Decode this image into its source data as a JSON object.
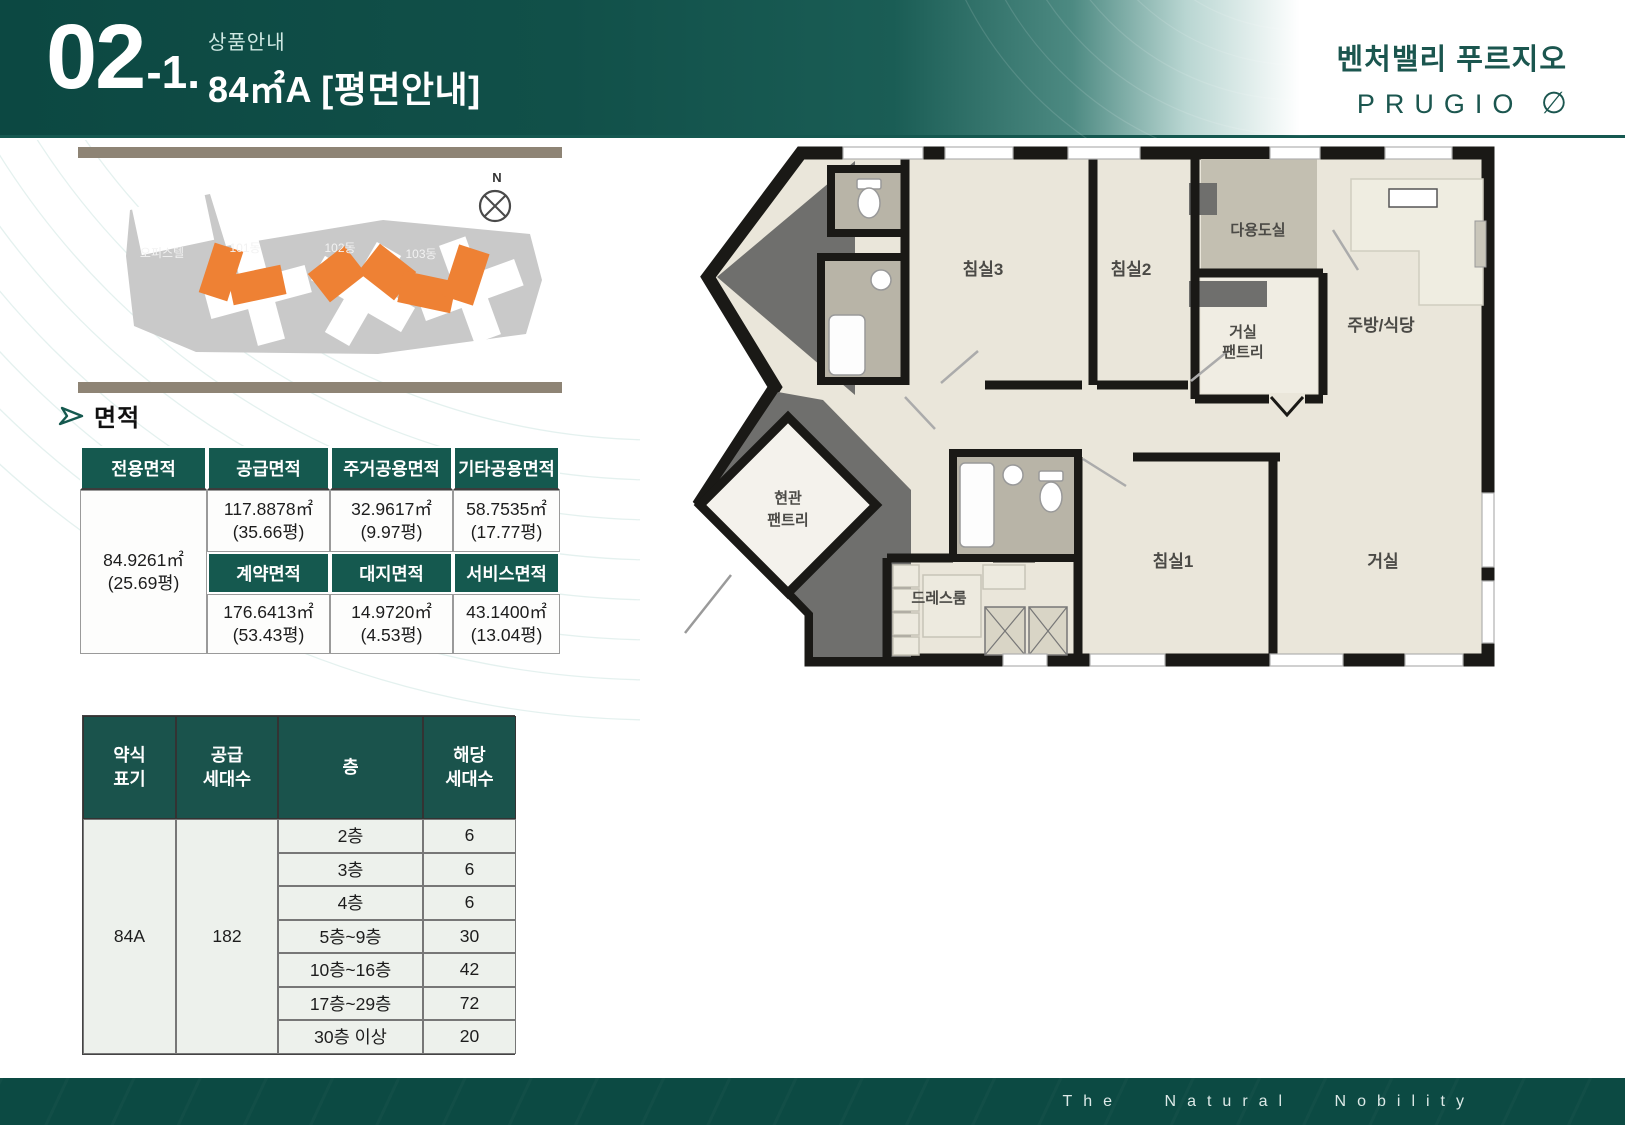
{
  "header": {
    "num": "02",
    "num_suffix": "-1.",
    "category": "상품안내",
    "title": "84㎡A [평면안내]",
    "accent_color": "#15594f"
  },
  "brand": {
    "kr": "벤처밸리 푸르지오",
    "en": "PRUGIO",
    "symbol": "∅",
    "color": "#1b564f"
  },
  "site": {
    "labels": {
      "officetel": "오피스텔",
      "b101": "101동",
      "b102": "102동",
      "b103": "103동"
    },
    "compass_n": "N",
    "highlight_color": "#ee8134"
  },
  "area": {
    "title": "면적",
    "headers": {
      "exclusive": "전용면적",
      "supply": "공급면적",
      "residential_common": "주거공용면적",
      "other_common": "기타공용면적",
      "contract": "계약면적",
      "land": "대지면적",
      "service": "서비스면적"
    },
    "exclusive": {
      "value": "84.9261㎡",
      "pyeong": "(25.69평)"
    },
    "supply": {
      "value": "117.8878㎡",
      "pyeong": "(35.66평)"
    },
    "residential": {
      "value": "32.9617㎡",
      "pyeong": "(9.97평)"
    },
    "other": {
      "value": "58.7535㎡",
      "pyeong": "(17.77평)"
    },
    "contract": {
      "value": "176.6413㎡",
      "pyeong": "(53.43평)"
    },
    "land": {
      "value": "14.9720㎡",
      "pyeong": "(4.53평)"
    },
    "service": {
      "value": "43.1400㎡",
      "pyeong": "(13.04평)"
    }
  },
  "units": {
    "headers": [
      "약식\n표기",
      "공급\n세대수",
      "층",
      "해당\n세대수"
    ],
    "type": "84A",
    "total": "182",
    "rows": [
      {
        "floor": "2층",
        "count": "6"
      },
      {
        "floor": "3층",
        "count": "6"
      },
      {
        "floor": "4층",
        "count": "6"
      },
      {
        "floor": "5층~9층",
        "count": "30"
      },
      {
        "floor": "10층~16층",
        "count": "42"
      },
      {
        "floor": "17층~29층",
        "count": "72"
      },
      {
        "floor": "30층 이상",
        "count": "20"
      }
    ]
  },
  "plan": {
    "rooms": {
      "bedroom3": "침실3",
      "bedroom2": "침실2",
      "utility": "다용도실",
      "pantry_l1": "거실",
      "pantry_l2": "팬트리",
      "kitchen": "주방/식당",
      "entry1": "현관",
      "entry2": "팬트리",
      "dress": "드레스룸",
      "bedroom1": "침실1",
      "living": "거실"
    }
  },
  "footer": {
    "slogan": "The Natural Nobility"
  }
}
